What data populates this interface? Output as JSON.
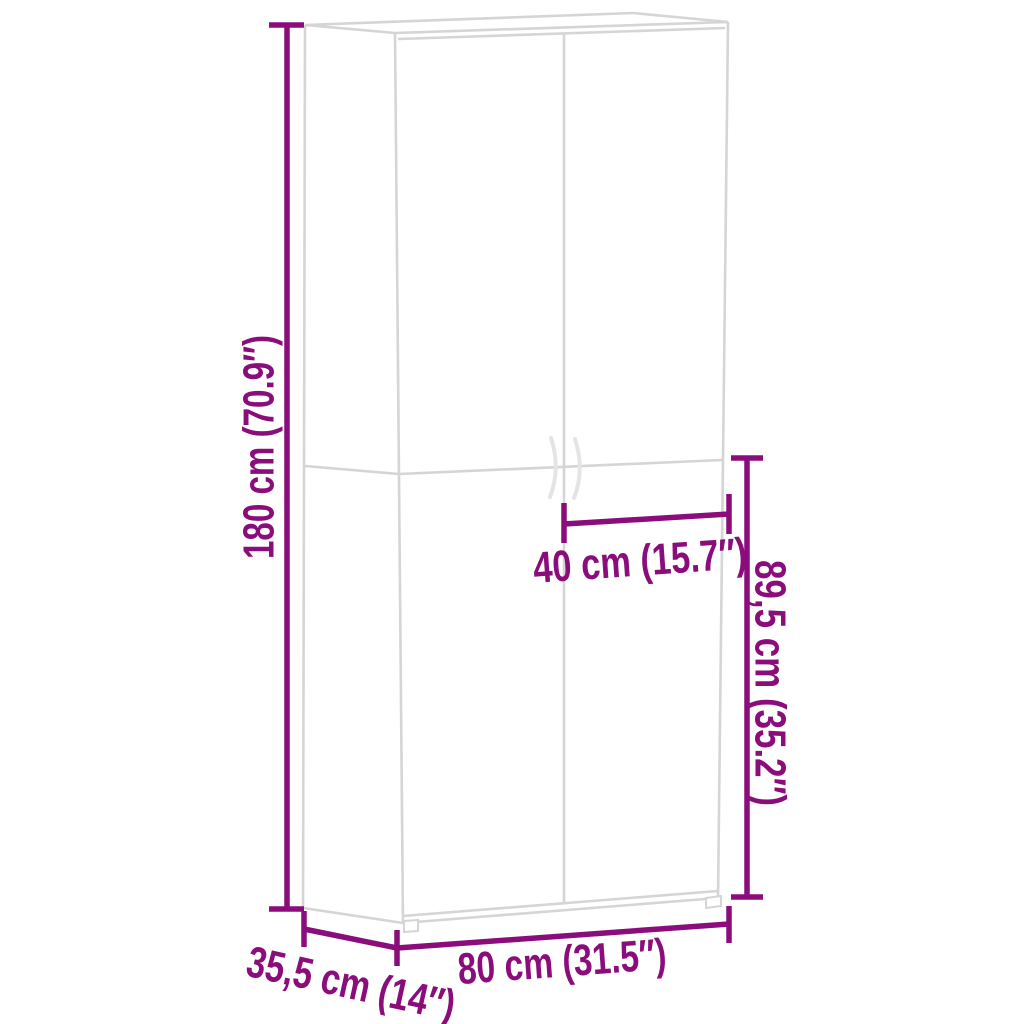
{
  "page": {
    "background": "#ffffff",
    "kind": "furniture-dimension-diagram",
    "subject": "two-door-cabinet-wireframe"
  },
  "colors": {
    "dimension_accent": "#8a0d7b",
    "cabinet_outline": "#d5d5d5",
    "handle_stroke": "#e4e4e4"
  },
  "dimensions": {
    "height": {
      "label": "180 cm (70.9″)",
      "metric": "180 cm",
      "imperial": "70.9″",
      "placement": "left-vertical"
    },
    "door_width": {
      "label": "40 cm (15.7″)",
      "metric": "40 cm",
      "imperial": "15.7″",
      "placement": "center-horizontal"
    },
    "lower_section_height": {
      "label": "89,5 cm (35.2″)",
      "metric": "89,5 cm",
      "imperial": "35.2″",
      "placement": "right-vertical"
    },
    "width": {
      "label": "80 cm (31.5″)",
      "metric": "80 cm",
      "imperial": "31.5″",
      "placement": "bottom-horizontal"
    },
    "depth": {
      "label": "35,5 cm (14″)",
      "metric": "35,5 cm",
      "imperial": "14″",
      "placement": "bottom-left-diagonal"
    }
  }
}
